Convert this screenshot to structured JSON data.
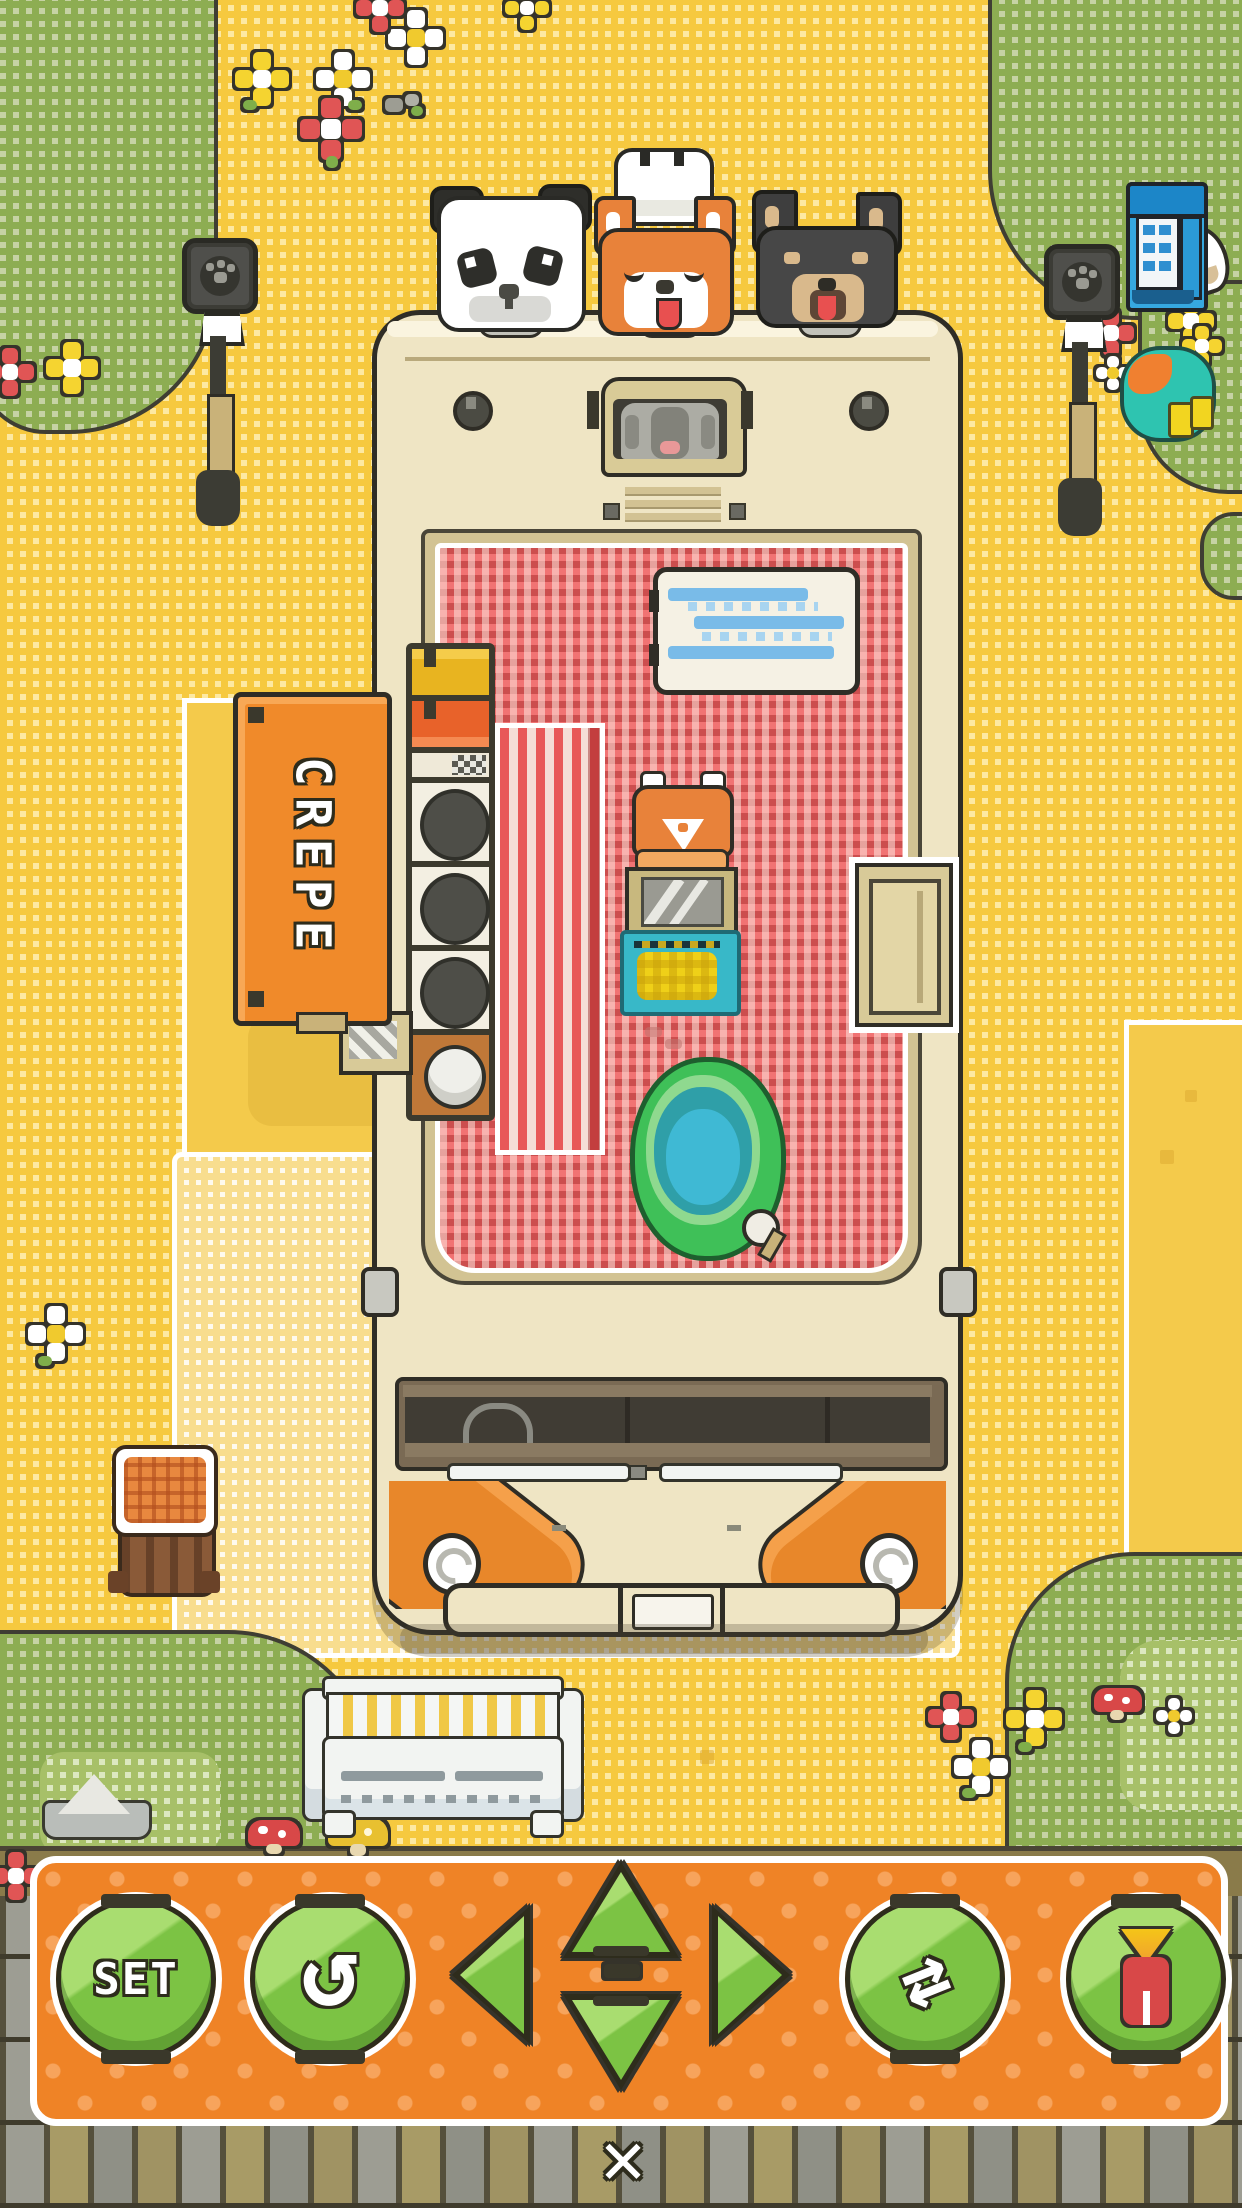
{
  "meta": {
    "app": "pet cafe truck placement editor",
    "mode": "furniture/vehicle move mode"
  },
  "sign": {
    "text": "CREPE"
  },
  "hud": {
    "set_label": "SET",
    "undo_glyph": "↺",
    "cycle_glyph": "⇄",
    "close_glyph": "✕",
    "buttons": [
      "set",
      "undo",
      "move-left",
      "move-up",
      "move-down",
      "move-right",
      "cycle",
      "shop"
    ]
  },
  "icons": [
    "paw-icon",
    "undo-icon",
    "arrow-left-icon",
    "arrow-up-icon",
    "arrow-down-icon",
    "arrow-right-icon",
    "cycle-icon",
    "shop-stall-icon",
    "close-icon"
  ],
  "scene_objects": [
    "crepe-truck",
    "panda",
    "shiba-chef",
    "black-shiba",
    "koala-driver",
    "crepe-sign",
    "griddle-shelf",
    "cooler-box",
    "crepe-station",
    "water-bucket",
    "side-door",
    "street-lamp-left",
    "street-lamp-right",
    "vending-machine",
    "picnic-set",
    "bench",
    "waffle-stump",
    "rock",
    "flowers",
    "mushrooms",
    "placement-mats"
  ],
  "colors": {
    "ground": "#f6c93f",
    "grass": "#8dad52",
    "truck_cream": "#efe5c4",
    "floor": "#f17373",
    "sign_orange": "#f08a2a",
    "panel": "#ef8326",
    "button": "#7cc344",
    "bucket_green": "#3fc058",
    "cooler_blue": "#79bbe8",
    "vending_blue": "#36a8e0",
    "fender_orange": "#e8872a"
  }
}
